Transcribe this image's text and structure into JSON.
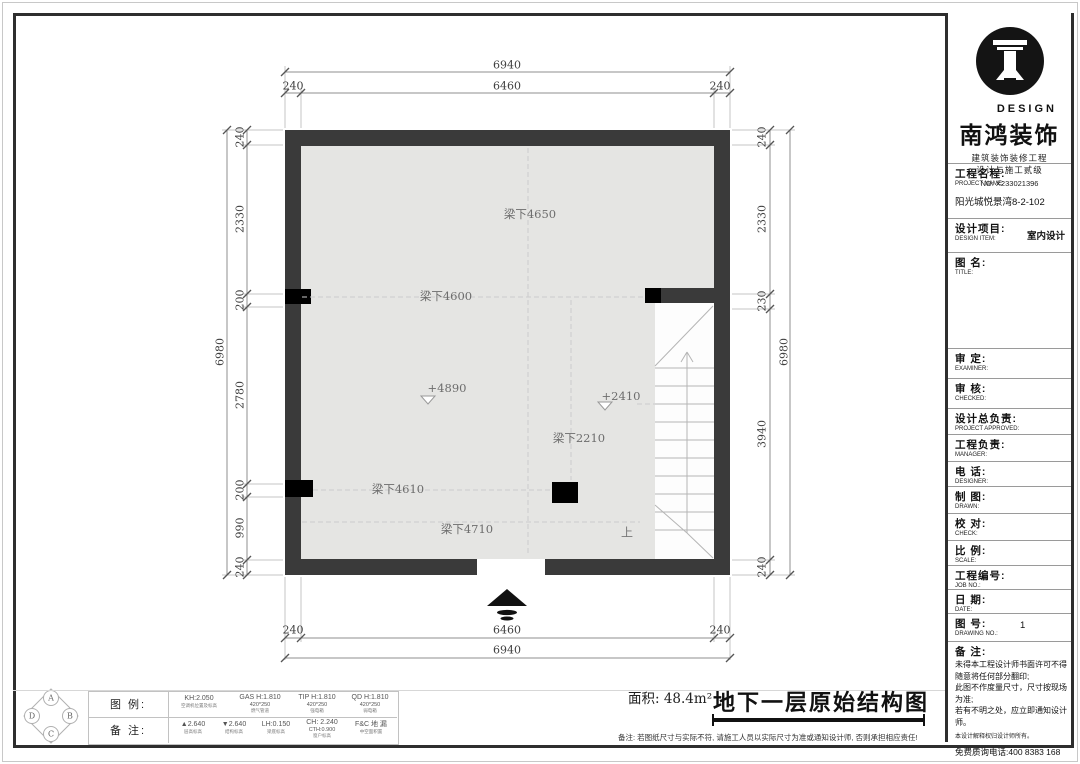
{
  "brand": {
    "design": "DESIGN",
    "company": "南鸿装饰",
    "qual1": "建筑装饰装修工程",
    "qual2": "设计与施工贰级",
    "license": "NO: X233021396"
  },
  "titleblock": {
    "fields": [
      {
        "label": "工程名程:",
        "sub": "PROJECT NAME:",
        "value": "阳光城悦景湾8-2-102"
      },
      {
        "label": "设计项目:",
        "sub": "DESIGN ITEM:",
        "value": "室内设计"
      },
      {
        "label": "图  名:",
        "sub": "TITLE:",
        "value": ""
      },
      {
        "label": "审  定:",
        "sub": "EXAMINER:",
        "value": ""
      },
      {
        "label": "审  核:",
        "sub": "CHECKED:",
        "value": ""
      },
      {
        "label": "设计总负责:",
        "sub": "PROJECT APPROVED:",
        "value": ""
      },
      {
        "label": "工程负责:",
        "sub": "MANAGER:",
        "value": ""
      },
      {
        "label": "电  话:",
        "sub": "DESIGNER:",
        "value": ""
      },
      {
        "label": "制  图:",
        "sub": "DRAWN:",
        "value": ""
      },
      {
        "label": "校  对:",
        "sub": "CHECK:",
        "value": ""
      },
      {
        "label": "比  例:",
        "sub": "SCALE:",
        "value": ""
      },
      {
        "label": "工程编号:",
        "sub": "JOB NO.:",
        "value": ""
      },
      {
        "label": "日  期:",
        "sub": "DATE:",
        "value": ""
      },
      {
        "label": "图  号:",
        "sub": "DRAWING NO.:",
        "value": "1"
      }
    ],
    "notes_label": "备 注:",
    "note1": "未得本工程设计师书面许可不得随意将任何部分翻印;",
    "note2": "此图不作度量尺寸，尺寸按现场为准;",
    "note3": "若有不明之处，应立即通知设计师。",
    "note_small": "本设计解释权归设计师所有。",
    "hotline": "免费质询电话:400 8383 168"
  },
  "plan": {
    "dims": {
      "top_overall": "6940",
      "top_left": "240",
      "top_mid": "6460",
      "top_right": "240",
      "bottom_left": "240",
      "bottom_mid": "6460",
      "bottom_right": "240",
      "bottom_overall": "6940",
      "left_overall": "6980",
      "left_segments": [
        "240",
        "2330",
        "200",
        "2780",
        "200",
        "990",
        "240"
      ],
      "right_overall": "6980",
      "right_segments": [
        "240",
        "2330",
        "230",
        "3940",
        "240"
      ]
    },
    "labels": {
      "beam1": "梁下4650",
      "beam2": "梁下4600",
      "level1": "+4890",
      "level2": "+2410",
      "beam3": "梁下2210",
      "beam4": "梁下4610",
      "beam5": "梁下4710",
      "up": "上"
    }
  },
  "footer": {
    "legend_label": "图 例:",
    "remark_label": "备 注:",
    "legend": [
      {
        "line1": "KH:2.050",
        "line2": "",
        "caption": "空调机位置及标高"
      },
      {
        "line1": "GAS H:1.810",
        "line2": "420*250",
        "caption": "燃气管道"
      },
      {
        "line1": "TIP H:1.810",
        "line2": "420*250",
        "caption": "强电箱"
      },
      {
        "line1": "QD H:1.810",
        "line2": "420*250",
        "caption": "弱电箱"
      }
    ],
    "remarks": [
      {
        "line1": "▲2.640",
        "line2": "",
        "caption": "层高标高"
      },
      {
        "line1": "▼2.640",
        "line2": "",
        "caption": "结构标高"
      },
      {
        "line1": "LH:0.150",
        "line2": "",
        "caption": "梁底标高"
      },
      {
        "line1": "CH: 2.240",
        "line2": "CTH:0.900",
        "caption": "窗户标高"
      },
      {
        "line1": "F&C  地 漏",
        "line2": "",
        "caption": "中空面积置"
      }
    ],
    "compass": {
      "a": "A",
      "b": "B",
      "c": "C",
      "d": "D"
    },
    "area": "面积: 48.4m²",
    "drawing_title": "地下一层原始结构图",
    "note": "备注: 若图纸尺寸与实际不符, 请施工人员以实际尺寸为准或通知设计师, 否则承担相应责任!"
  },
  "colors": {
    "wall": "#3a3a3a",
    "floor": "#e5e5e3",
    "ink": "#111111"
  }
}
